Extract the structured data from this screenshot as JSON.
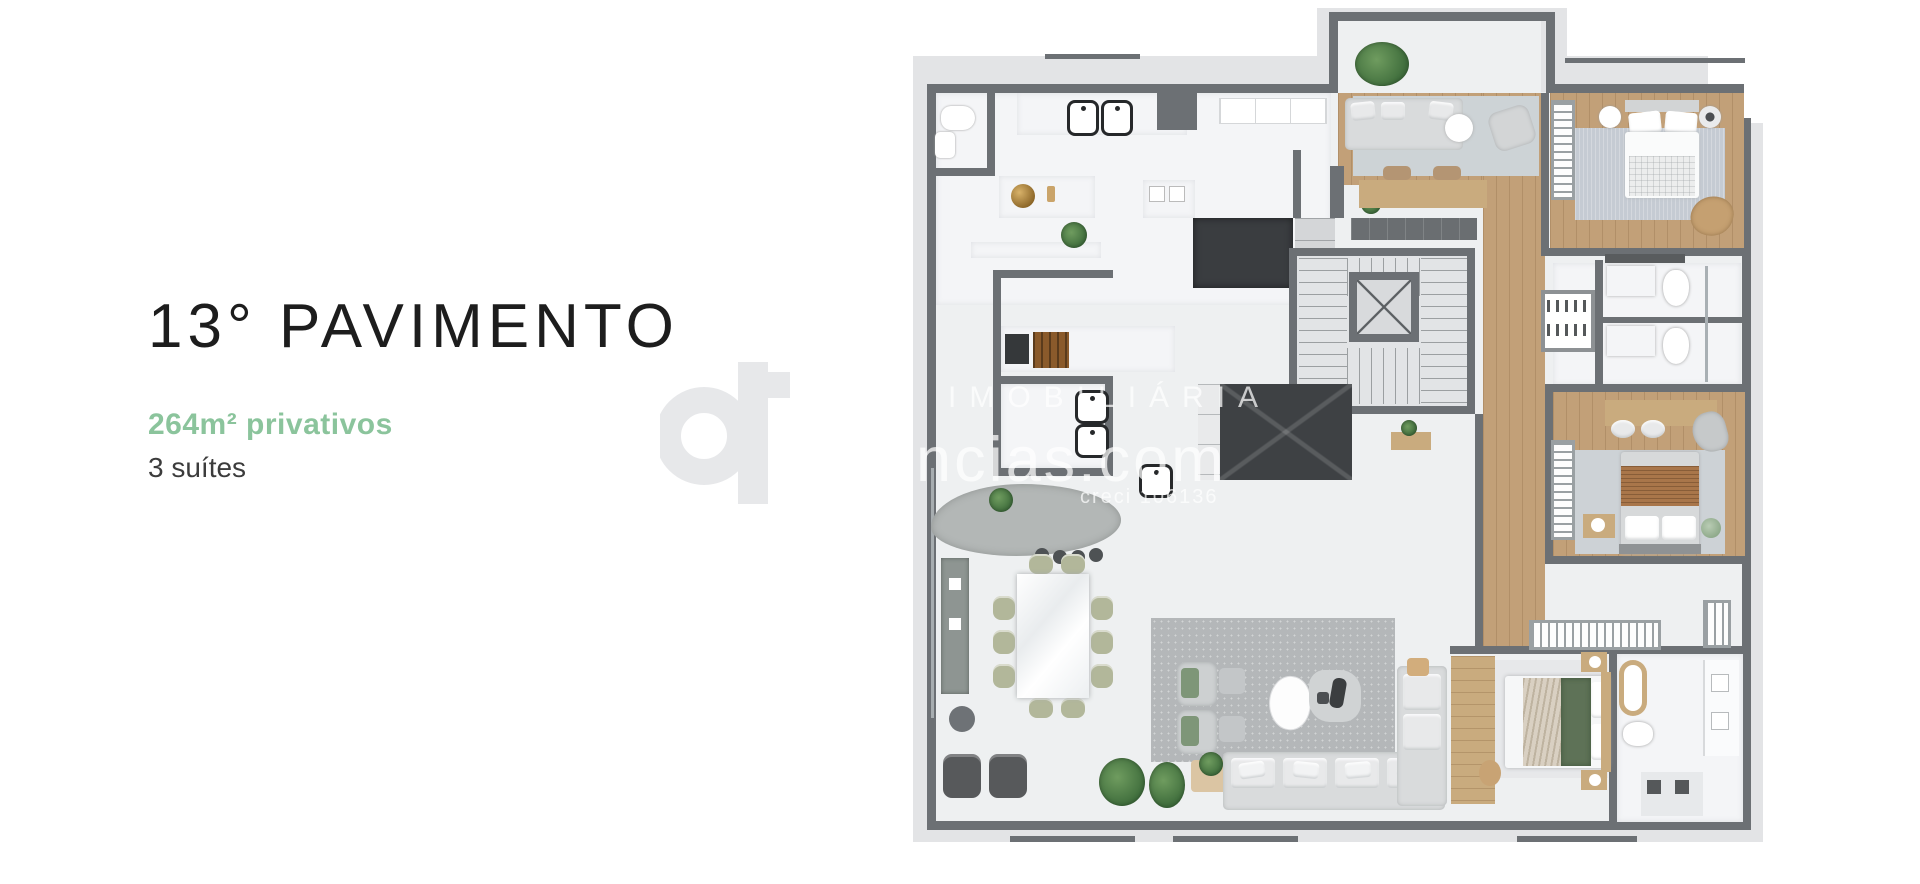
{
  "page": {
    "background_color": "#ffffff"
  },
  "left_panel": {
    "title": "13° PAVIMENTO",
    "area_highlight": "264m² privativos",
    "suites": "3 suítes",
    "title_color": "#1d1d1d",
    "area_color": "#8bc49c",
    "suites_color": "#3c3c3c"
  },
  "watermark": {
    "logo_icon": "realty-logo-glyph",
    "line1": "IMOBILIÁRIA",
    "line2": "ências.com",
    "line3": "creci 106136",
    "text_color": "rgba(255,255,255,0.72)"
  },
  "floor_plan": {
    "colors": {
      "walls": "#6c7074",
      "exterior_slab": "#e3e4e6",
      "interior_floor": "#eef0f1",
      "wood_floor": "#c2a078",
      "marble": "#f4f5f7",
      "dark_island": "#3a3d40",
      "bedroom_rug": "#c5cbd3",
      "living_rug": "#b4b7b9",
      "dining_chair_olive": "#b2b79a",
      "duvet_green": "#5e7257",
      "blanket_rust": "#a9764a",
      "brass_decor": "#b08a3e",
      "plant_green": "#4c7a4c"
    }
  }
}
